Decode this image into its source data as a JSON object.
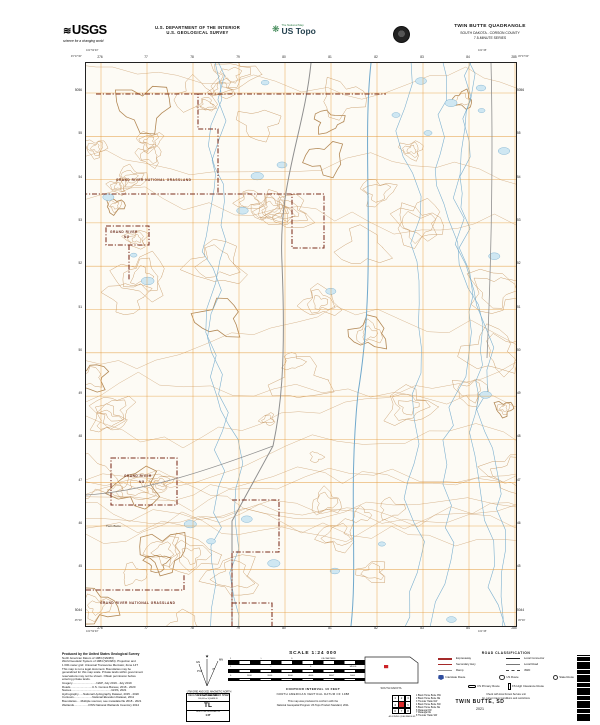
{
  "colors": {
    "paper": "#fdfbf5",
    "contour": "#c89a67",
    "contour_index": "#ab7c45",
    "grid_orange": "#e59f45",
    "water_line": "#6fa8cc",
    "water_fill": "#cfe7f2",
    "boundary_red": "#7c2d1c",
    "road_gray": "#8f8f8f",
    "locator_red": "#cc2328",
    "interstate_blue": "#2f4d9e"
  },
  "header": {
    "usgs": {
      "name": "USGS",
      "tagline": "science for a changing world"
    },
    "department": [
      "U.S. DEPARTMENT OF THE INTERIOR",
      "U.S. GEOLOGICAL SURVEY"
    ],
    "ustopo": {
      "brand": "The National Map",
      "name": "US Topo"
    },
    "title": {
      "quad": "TWIN BUTTE QUADRANGLE",
      "state_county": "SOUTH DAKOTA - CORSON COUNTY",
      "series": "7.5-MINUTE SERIES"
    }
  },
  "map": {
    "edge": {
      "top": [
        "276",
        "77",
        "78",
        "79",
        "80",
        "81",
        "82",
        "83",
        "84",
        "285"
      ],
      "bottom": [
        "276",
        "77",
        "78",
        "79",
        "80",
        "81",
        "82",
        "83",
        "84",
        "285"
      ],
      "left": [
        "5056",
        "55",
        "54",
        "53",
        "52",
        "51",
        "50",
        "49",
        "48",
        "47",
        "46",
        "45",
        "5044"
      ],
      "right": [
        "5056",
        "55",
        "54",
        "53",
        "52",
        "51",
        "50",
        "49",
        "48",
        "47",
        "46",
        "45",
        "5044"
      ]
    },
    "corners": {
      "tl_lat": "45°37'30\"",
      "tl_lon": "101°52'30\"",
      "tr_lat": "45°37'30\"",
      "tr_lon": "101°45'",
      "bl_lat": "45°30'",
      "bl_lon": "101°52'30\"",
      "br_lat": "45°30'",
      "br_lon": "101°45'"
    },
    "labels": [
      {
        "text": "GRAND RIVER NATIONAL GRASSLAND",
        "x": 30,
        "y": 118,
        "kind": "admin"
      },
      {
        "text": "GRAND RIVER",
        "x": 24,
        "y": 170,
        "kind": "admin"
      },
      {
        "text": "NG",
        "x": 38,
        "y": 175,
        "kind": "admin"
      },
      {
        "text": "GRAND RIVER",
        "x": 38,
        "y": 414,
        "kind": "admin"
      },
      {
        "text": "NG",
        "x": 53,
        "y": 420,
        "kind": "admin"
      },
      {
        "text": "GRAND RIVER NATIONAL GRASSLAND",
        "x": 14,
        "y": 541,
        "kind": "admin"
      },
      {
        "text": "Twin Butte",
        "x": 20,
        "y": 464,
        "kind": "feature"
      }
    ]
  },
  "footer": {
    "produced": "Produced by the United States Geological Survey",
    "fine_print": [
      "North American Datum of 1983 (NAD83)",
      "World Geodetic System of 1984 (WGS84). Projection and",
      "1 000-meter grid: Universal Transverse Mercator, Zone 14T",
      "This map is not a legal document. Boundaries may be",
      "generalized for this map scale. Private lands within government",
      "reservations may not be shown. Obtain permission before",
      "entering private lands.",
      " ",
      "Imagery..............................NAIP, July 2019 - July 2019",
      "Roads...........................U.S. Census Bureau, 2016 - 2020",
      "Names..................................................GNIS, 2021",
      "Hydrography......National Hydrography Dataset, 2015 - 2020",
      "Contours.......................National Elevation Dataset, 2011",
      "Boundaries.....Multiple sources; see metadata file 2018 - 2021",
      "Wetlands..................FWS National Wetlands Inventory 2014"
    ],
    "declination": {
      "gn_label": "GN",
      "mn_label": "MN",
      "gn_angle": "0°16'",
      "mn_angle": "8°",
      "caption1": "UTM GRID AND 2021 MAGNETIC NORTH",
      "caption2": "DECLINATION AT CENTER OF SHEET"
    },
    "usng": {
      "title": "U.S. NATIONAL GRID",
      "sub": "100,000-m SQUARE ID",
      "square": "TL",
      "zone_label": "GRID ZONE DESIGNATION",
      "zone": "14T"
    },
    "scale": {
      "title": "SCALE 1:24 000",
      "bars": [
        {
          "nums": [
            "1",
            "½",
            "0",
            "KILOMETERS",
            "1",
            "2"
          ]
        },
        {
          "nums": [
            "1",
            "½",
            "0",
            "MILES",
            "1"
          ]
        },
        {
          "nums": [
            "0",
            "1000",
            "2000",
            "3000",
            "4000",
            "FEET",
            "5000",
            "6000",
            "7000"
          ]
        }
      ],
      "contour": "CONTOUR INTERVAL 10 FEET",
      "datum": "NORTH AMERICAN VERTICAL DATUM OF 1988",
      "conform1": "This map was produced to conform with the",
      "conform2": "National Geospatial Program US Topo Product Standard, 2011."
    },
    "state_locator": {
      "name": "SOUTH DAKOTA"
    },
    "legend": {
      "title": "ROAD CLASSIFICATION",
      "items": [
        {
          "sample": "expressway",
          "label": "Expressway"
        },
        {
          "sample": "connector",
          "label": "Local Connector"
        },
        {
          "sample": "secondary",
          "label": "Secondary Hwy"
        },
        {
          "sample": "local",
          "label": "Local Road"
        },
        {
          "sample": "ramp",
          "label": "Ramp"
        },
        {
          "sample": "4wd",
          "label": "4WD"
        }
      ],
      "shields": [
        {
          "type": "interstate",
          "label": "Interstate Route"
        },
        {
          "type": "usroute",
          "label": "US Route"
        },
        {
          "type": "stateroute",
          "label": "State Route"
        }
      ],
      "fs_items": [
        {
          "type": "fs-primary",
          "label": "FS Primary Route"
        },
        {
          "type": "fs-high",
          "label": "FS High Clearance Route"
        }
      ],
      "notes": [
        "Check with local Forest Service unit",
        "for current travel conditions and restrictions"
      ]
    },
    "adjoining": {
      "caption": "ADJOINING QUADRANGLES",
      "numbers": [
        "1",
        "2",
        "3",
        "4",
        "5",
        "6",
        "7",
        "8"
      ],
      "names": [
        "1 Black Horse Butte NW",
        "2 Black Horse Butte NE",
        "3 Thunder Hawk NW",
        "4 Black Horse Butte SW",
        "5 Black Horse Butte SE",
        "6 Watauga NW",
        "7 Watauga NE",
        "8 Thunder Hawk SW"
      ]
    },
    "sheet_name": {
      "name": "TWIN BUTTE, SD",
      "year": "2021"
    }
  }
}
